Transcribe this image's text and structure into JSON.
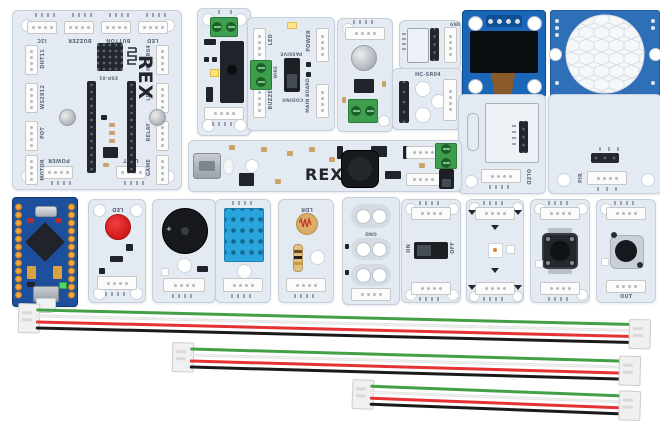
{
  "kit": {
    "brand": "REX",
    "description": "electronics kit modules and cables on white background"
  },
  "palette": {
    "module_board": "#e4eaf2",
    "module_edge": "#c5cfdb",
    "terminal_green": "#3d9e4d",
    "oled_pcb_blue": "#1a66b8",
    "pir_pcb_blue": "#2f6fb8",
    "mcu_blue": "#1d4f9c",
    "led_red": "#e02020",
    "dht_blue": "#2aa4dc",
    "wire_green": "#43a047",
    "wire_white": "#f2f2f2",
    "wire_red": "#e53235",
    "wire_black": "#1a1a1a"
  },
  "main_board": {
    "brand": "REX",
    "socket_label": "ESP-01",
    "top_ports": [
      "I2C",
      "BUZZER",
      "BUTTON",
      "LED"
    ],
    "left_ports": [
      "DHT11",
      "WS2812",
      "POT",
      "MOTOR"
    ],
    "right_ports": [
      "HC-SR04",
      "LDR",
      "RELAY",
      "GAME"
    ],
    "bottom_ports": [
      "POWER",
      "UART"
    ]
  },
  "modules": {
    "mode_board": {
      "ports": [
        "LED",
        "POWER",
        "BUZZER",
        "MAIN BOARD"
      ],
      "terminal_label": "WIRE",
      "switch_top": "PASSIVE",
      "switch_bottom": "CODING"
    },
    "breakout": {
      "pin_top": "GND"
    },
    "sonar_adapter": {
      "label": "HC-SR04"
    },
    "power_board": {
      "brand": "REX"
    },
    "oled_carrier": {
      "label": "OLED"
    },
    "pir_carrier": {
      "label": "PIR"
    },
    "led_module": {
      "label": "LED"
    },
    "buzzer_module": {
      "plus": "+"
    },
    "ldr_module": {
      "label": "LDR"
    },
    "pads_module": {
      "label_gnd": "GND"
    },
    "switch_module": {
      "on": "ON",
      "off": "OFF"
    },
    "pot_module": {
      "out": "OUT"
    }
  },
  "cables": {
    "count": 3,
    "connector": "JST 4-pin",
    "wire_colors": [
      "green",
      "white",
      "red",
      "black"
    ]
  }
}
